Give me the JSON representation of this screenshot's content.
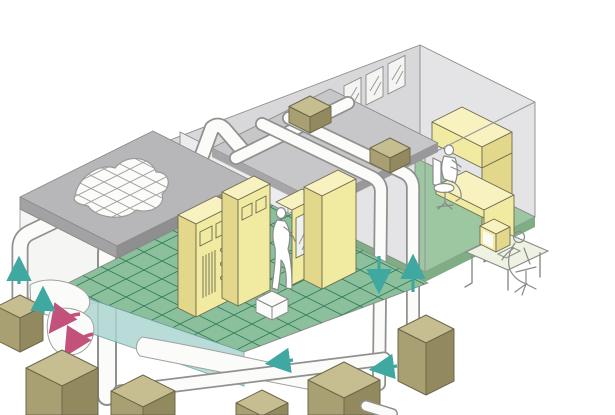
{
  "meta": {
    "kind": "isometric-technical-illustration",
    "subject": "Cleanroom HVAC air-circulation cutaway: filter ceiling, raised grid floor, recirculation ducts, equipment rooms and operators"
  },
  "colors": {
    "outline": "#8a8a88",
    "duct_fill": "#fbfbf9",
    "duct_outline": "#90908e",
    "wall_back": "#d8d8db",
    "wall_side": "#e4e4e7",
    "wall_white": "#f5f5f3",
    "wall_inner": "#ececee",
    "roof_top": "#b7b7b9",
    "roof_sw": "#a2a2a4",
    "roof_se": "#8f8f91",
    "deck": "#c7c7ca",
    "window_glass": "#f4f4f2",
    "slot_dark": "#4f4f52",
    "floor_grid_green": "#8cc09c",
    "grid_line": "#2e7a57",
    "floor_plain_green": "#9cc7a1",
    "floor_edge_green": "#7fae85",
    "tile_teal": "#aed6d3",
    "cab_yellow_face": "#f1eba2",
    "cab_yellow_top": "#f7f2c0",
    "cab_yellow_side": "#e2d78a",
    "glass_door": "#eef2ef",
    "box_top": "#c6bd90",
    "box_left": "#a89f72",
    "box_right": "#928a5e",
    "box_outline": "#6e684c",
    "dark_panel": "#4a4a4c",
    "dark_panel_inner": "#636366",
    "arrow_teal": "#3fa8a0",
    "arrow_pink": "#c2517c",
    "person_fill": "#ffffff",
    "person_outline": "#8a8a88",
    "monitor_screen": "#fafaf5",
    "desk_top_tint": "#edf2e2",
    "ceil_grid_line": "#a0a09e"
  },
  "scene": {
    "rooms": [
      {
        "name": "filter-ceiling-room",
        "features": [
          "cutaway gray roof",
          "ceiling HEPA filter grid",
          "torn white walls",
          "dark wall control panel",
          "raised green grid floor",
          "service stool"
        ]
      },
      {
        "name": "equipment-room",
        "features": [
          "yellow process cabinets",
          "gauge-and-knob panel",
          "glass-door unit",
          "standing technician",
          "hatched wall vents",
          "window"
        ]
      },
      {
        "name": "office-room",
        "features": [
          "three back windows",
          "yellow workbench with hutch",
          "seated worker on chair",
          "plain green floor",
          "transparent front walls"
        ]
      }
    ],
    "airflow": {
      "left_riser_arrows_up": 2,
      "right_pair_arrow_down": 1,
      "right_pair_arrow_up": 1,
      "bottom_duct_arrows_left": 2,
      "underfloor_recirculation_arrows_pink": 2
    },
    "equipment": {
      "duct_deck_boxes": 2,
      "ground_units": 7,
      "duct_style": "white rectangular ducts with rounded bends",
      "descending_duct_pair": true,
      "west_loop_duct": true
    },
    "people": [
      {
        "pose": "standing",
        "location": "equipment-room"
      },
      {
        "pose": "seated-at-workbench",
        "location": "office-room"
      },
      {
        "pose": "seated-at-computer",
        "location": "outside-front-right"
      }
    ]
  }
}
